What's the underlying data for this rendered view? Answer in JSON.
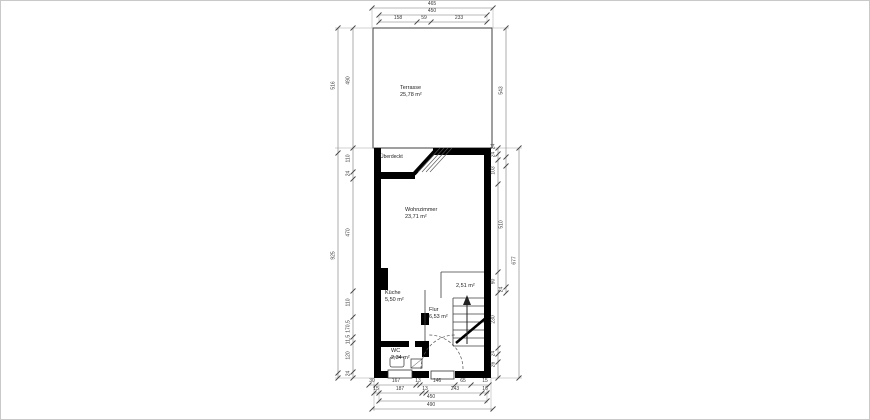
{
  "plan": {
    "rooms": {
      "terrasse": {
        "name": "Terrasse",
        "area": "25,78 m²"
      },
      "wohnzimmer": {
        "name": "Wohnzimmer",
        "area": "23,71 m²"
      },
      "kueche": {
        "name": "Küche",
        "area": "5,50 m²"
      },
      "flur": {
        "name": "Flur",
        "area": "6,53 m²"
      },
      "wc": {
        "name": "WC",
        "area": "2,34 m²"
      },
      "abstellraum": {
        "area": "2,51 m²"
      }
    },
    "notes": {
      "covered": "Überdeckt"
    },
    "dims": {
      "top1": "465",
      "top2": "450",
      "top_segs": [
        "158",
        "59",
        "233"
      ],
      "left_outer": [
        "516",
        "925"
      ],
      "left_inner": [
        "490",
        "110",
        "24",
        "470",
        "110",
        "170,5",
        "11,5",
        "120",
        "24"
      ],
      "right_inner": [
        "24",
        "24",
        "103",
        "90",
        "230",
        "24",
        "26"
      ],
      "right_mid": [
        "543",
        "510",
        "24"
      ],
      "right_outer": [
        "677"
      ],
      "bottom_row1": [
        "30",
        "167",
        "13",
        "146",
        "65",
        "15"
      ],
      "bottom_row2": [
        "15",
        "187",
        "13",
        "243",
        "16"
      ],
      "bottom_total": "450",
      "bottom_overall": "490"
    },
    "colors": {
      "wall": "#000000",
      "thin_line": "#3f3f3f",
      "dim_line": "#777777",
      "text": "#3a3a3a"
    }
  }
}
